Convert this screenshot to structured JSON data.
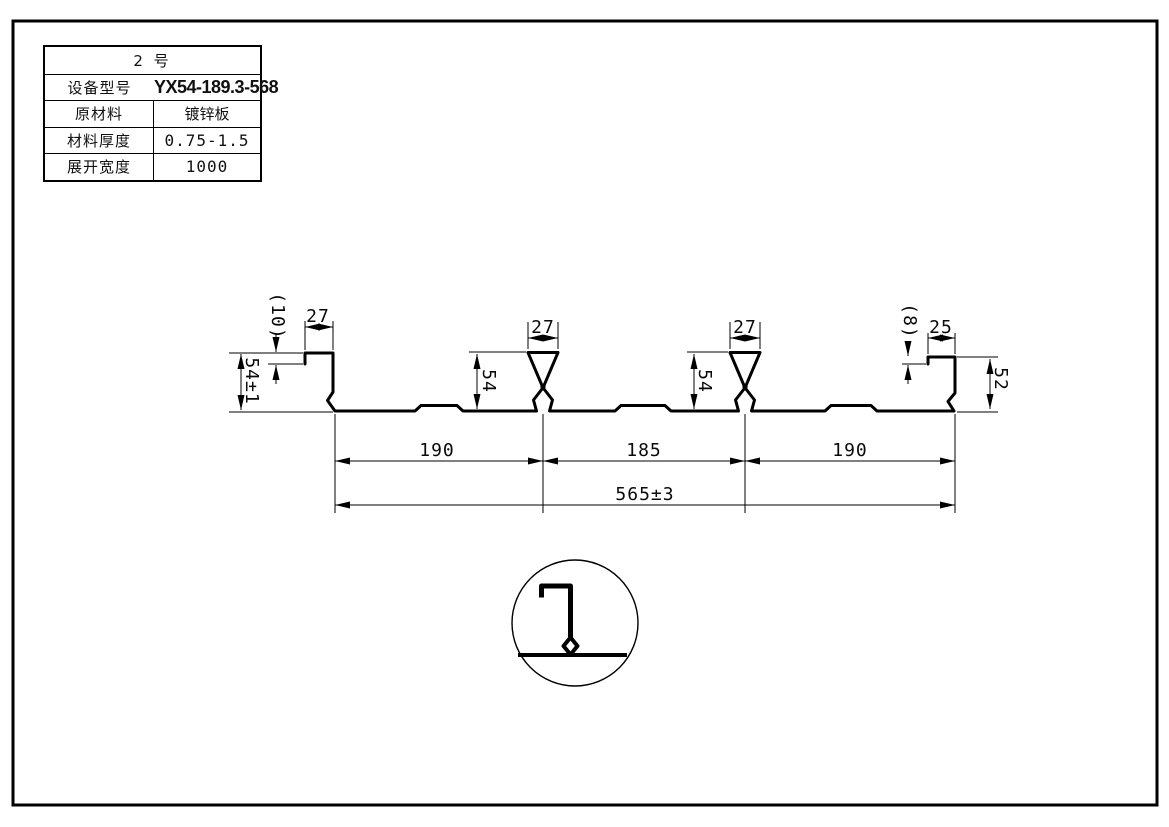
{
  "table": {
    "title": "2 号",
    "rows": [
      {
        "label": "设备型号",
        "value": "YX54-189.3-568"
      },
      {
        "label": "原材料",
        "value": "镀锌板"
      },
      {
        "label": "材料厚度",
        "value": "0.75-1.5"
      },
      {
        "label": "展开宽度",
        "value": "1000"
      }
    ]
  },
  "dims": {
    "left_step": "(10)",
    "left_lip_width": "27",
    "left_height": "54±1",
    "rib1_width": "27",
    "rib1_height": "54",
    "rib2_width": "27",
    "rib2_height": "54",
    "right_step": "(8)",
    "right_lip_width": "25",
    "right_height": "52",
    "pitch_left": "190",
    "pitch_mid": "185",
    "pitch_right": "190",
    "overall_width": "565±3"
  }
}
